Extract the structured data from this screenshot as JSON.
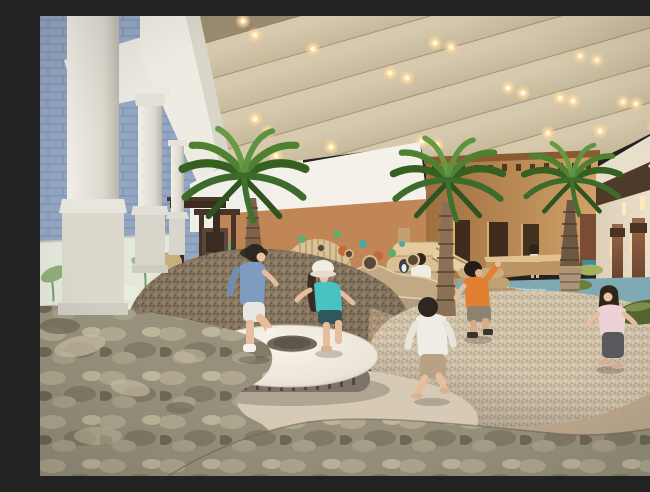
{
  "meta": {
    "title": "Indoor kids' sand-play lounge — architectural rendering",
    "alt": "Photorealistic rendering of an indoor children's play area: wavy acoustic ceiling with warm downlights, white classical columns by a glass wall with plants, indoor palm trees, an adobe-style tan playhouse, pebbled sand mounds, a white donut-shaped trampoline, a shallow teal stream, green bean poufs, rust door panels with sconces, and children playing."
  },
  "palette": {
    "ceiling_base": "#9a8b70",
    "ceiling_wave": "#c6b89c",
    "ceiling_shadow": "#8e7e62",
    "light_warm": "#ffdf9e",
    "column_white": "#eceadf",
    "exterior_wall_blue": "#93a6c2",
    "white_band": "#f4f1ea",
    "back_wall_tan": "#c08655",
    "building_tan": "#c2925e",
    "door_rust": "#8a5a40",
    "wood_play": "#d9bc8e",
    "mound_dark": "#8a7a64",
    "mound_light": "#cfc0a8",
    "sand_apron": "#d7cab4",
    "carpet_mottled": "#97917c",
    "water_teal": "#7fa9b3",
    "pouf_green": "#a3b060",
    "pouf_olive": "#55652f",
    "trampoline_top": "#f1ebe1",
    "trampoline_hole": "#74685a",
    "palm_green": "#4c7a33",
    "child_denim": "#7d9cc0",
    "child_teal": "#49c2c4",
    "child_orange": "#e08030",
    "child_pink": "#ecd2d6"
  },
  "scene": {
    "children": [
      {
        "id": "boy-denim-jumping",
        "clothing": "denim shirt, white shorts, white shoes"
      },
      {
        "id": "girl-teal-hat",
        "clothing": "teal top, dark shorts, white bucket hat"
      },
      {
        "id": "boy-white-shirt",
        "clothing": "white long sleeve, beige pants, barefoot"
      },
      {
        "id": "boy-orange-shirt",
        "clothing": "orange tee, gray shorts"
      },
      {
        "id": "girl-pink-top",
        "clothing": "pink top, dark leggings"
      },
      {
        "id": "girl-white-dress-back",
        "clothing": "white dress, at counter"
      },
      {
        "id": "girl-on-platform",
        "clothing": "white top, sitting by slide"
      },
      {
        "id": "adult-seated-lounge",
        "clothing": "light top, wicker chair"
      }
    ],
    "objects": [
      "wavy acoustic ceiling with warm downlights",
      "white classical columns",
      "blue brick exterior wall",
      "glass wall planting trough",
      "indoor palm trees",
      "adobe-style tan playhouse with beam holes",
      "porthole and colored dot wall decor",
      "slatted wooden dome",
      "timber play structure with slide",
      "white donut trampoline",
      "pebbled sand mounds",
      "shallow teal stream",
      "green bean poufs",
      "rust door panels with sconces",
      "mottled carpet floor",
      "dark timber pergola and lounge chairs"
    ]
  }
}
